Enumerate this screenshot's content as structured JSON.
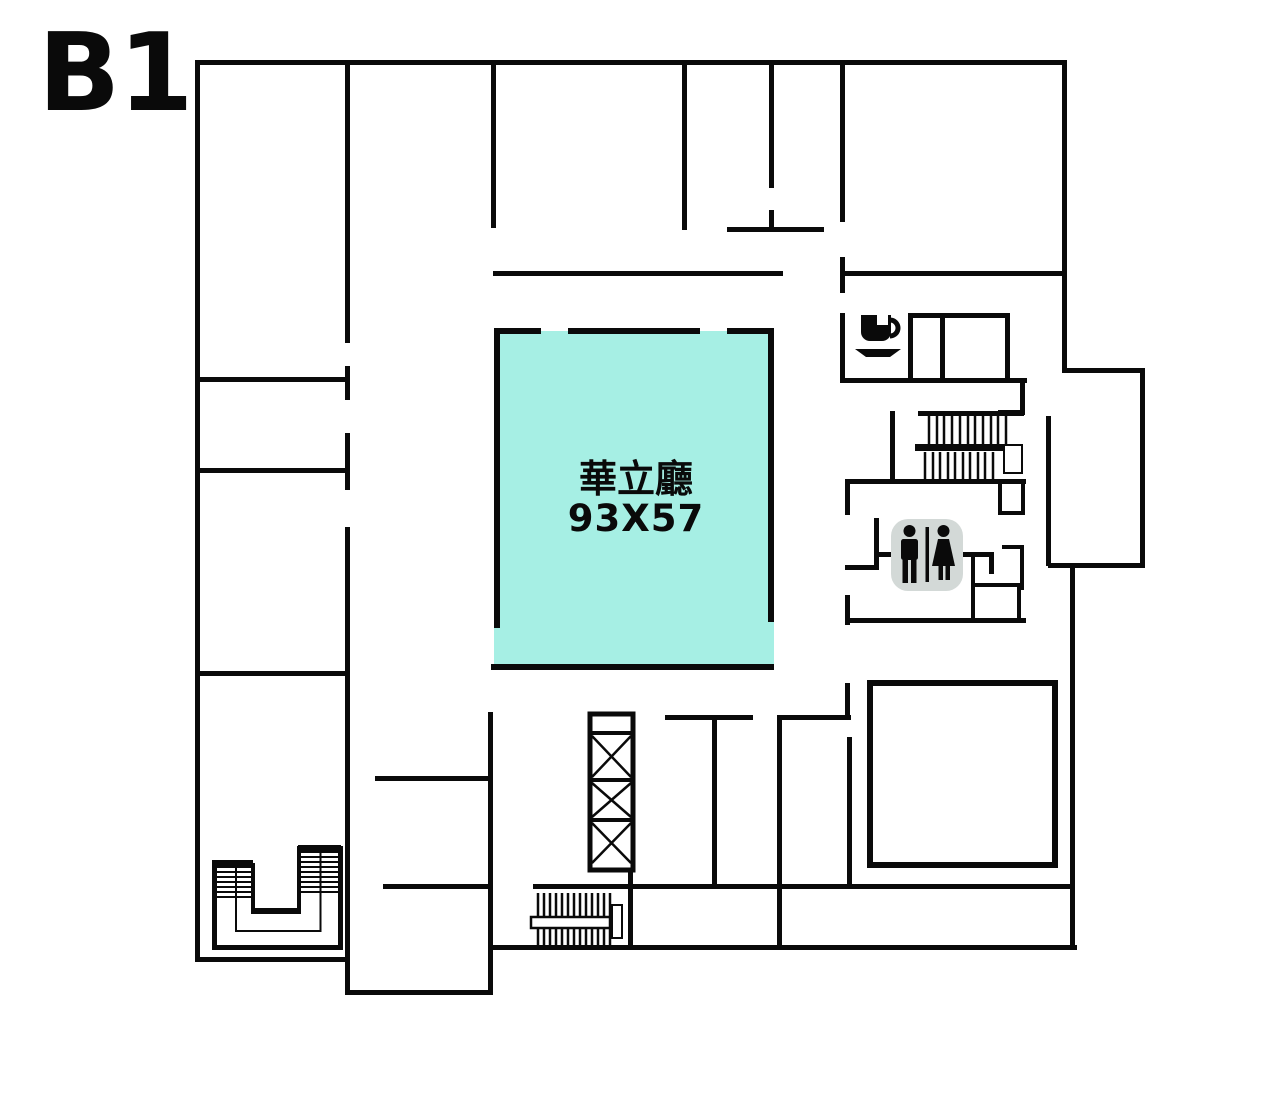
{
  "floor_label": "B1",
  "rooms": {
    "hall": {
      "name": "華立廳",
      "dimensions": "93X57"
    }
  },
  "colors": {
    "background": "#ffffff",
    "wall": "#0a0a0a",
    "text": "#0a0a0a",
    "hall_fill": "#a6efe4",
    "restroom_bg": "#d3d9d7",
    "icon": "#0a0a0a",
    "icon_inner": "#ffffff"
  },
  "icons": {
    "coffee": "coffee-cup-icon",
    "restroom": "restroom-men-women-icon",
    "elevator": "elevator-x-shaft-icon",
    "stairs_top_right": "stairs-icon",
    "stairs_bottom_center": "stairs-icon",
    "stairs_bottom_left": "stairs-u-turn-icon"
  }
}
